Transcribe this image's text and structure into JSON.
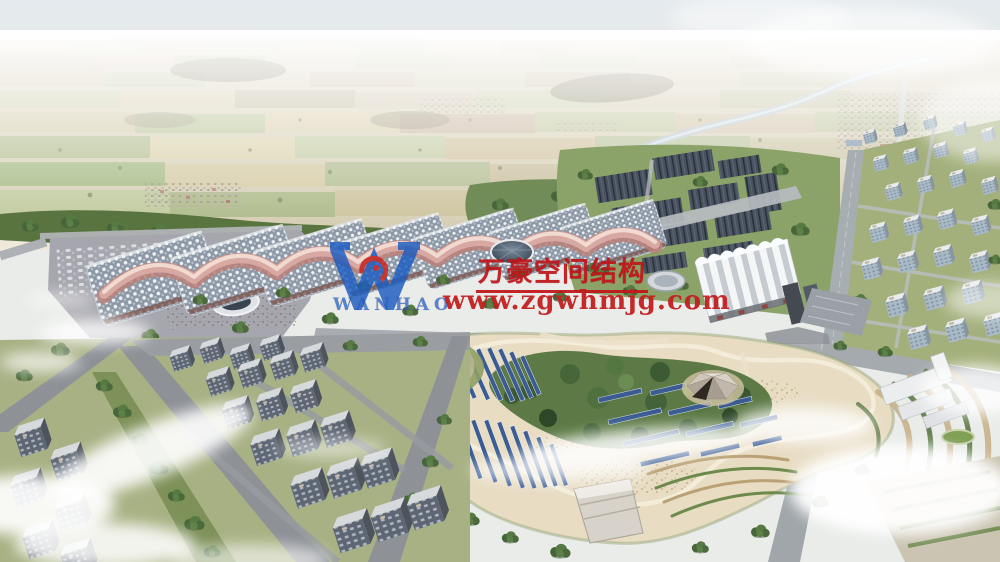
{
  "watermark": {
    "logo_text": "WANHAO",
    "title_cn": "万豪空间结构",
    "url": "www.zgwhmjg.com"
  },
  "colors": {
    "watermark-red": "#bf1519",
    "url-red": "#c31f1f",
    "logo-blue": "#1e5cc0",
    "logo-emblem-red": "#c82623",
    "roof-pink": "#d8a8a2",
    "roof-pink-light": "#f2dcd4",
    "solar-blue": "#3a5c92",
    "park-sand": "#e8dcc3",
    "greenery": "#5d7a46",
    "sky-top": "#e2e8ec"
  }
}
